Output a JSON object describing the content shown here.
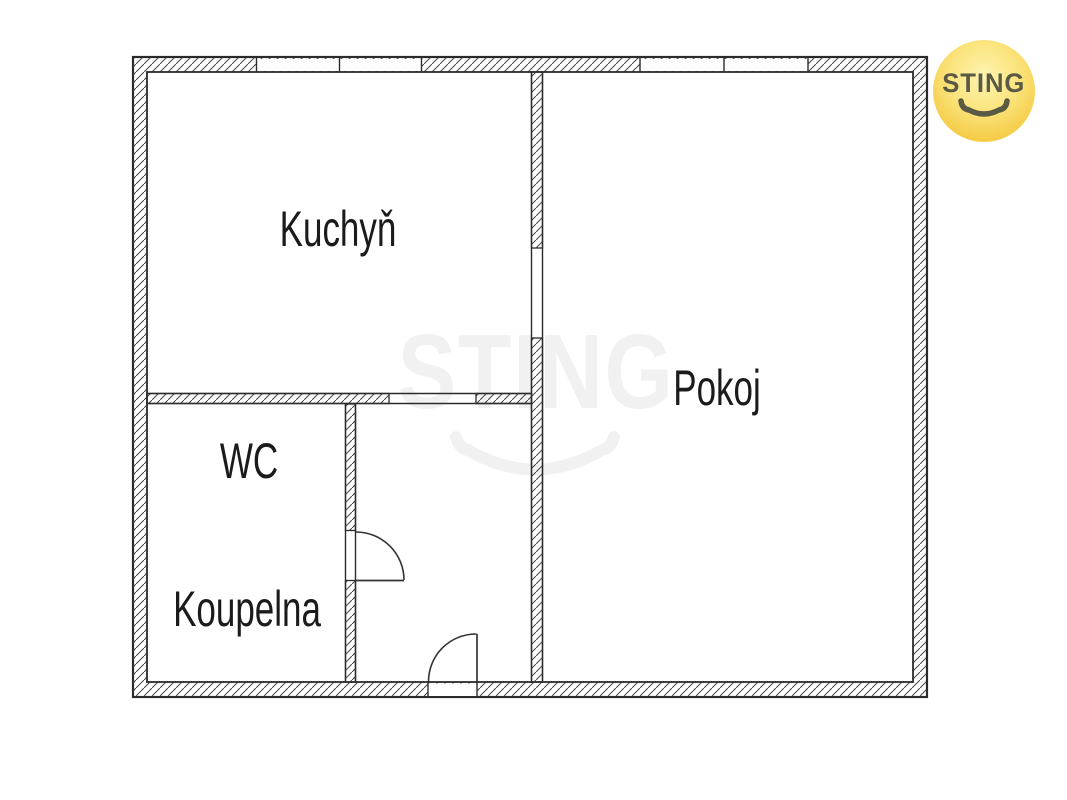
{
  "floorplan": {
    "rooms": [
      {
        "name": "kuchyn",
        "label": "Kuchyň"
      },
      {
        "name": "pokoj",
        "label": "Pokoj"
      },
      {
        "name": "wc",
        "label": "WC"
      },
      {
        "name": "koupelna",
        "label": "Koupelna"
      }
    ]
  },
  "watermark": {
    "text": "STING"
  },
  "logo": {
    "text": "STING"
  },
  "colors": {
    "background": "#ffffff",
    "wall_outline": "#2b2b2b",
    "hatch_line": "#474747",
    "door_line": "#333333",
    "label_text": "#1b1b1b",
    "watermark": "#f1f1f1",
    "logo_circle_yellow": "#f3c93f",
    "logo_text": "#5a5944"
  }
}
